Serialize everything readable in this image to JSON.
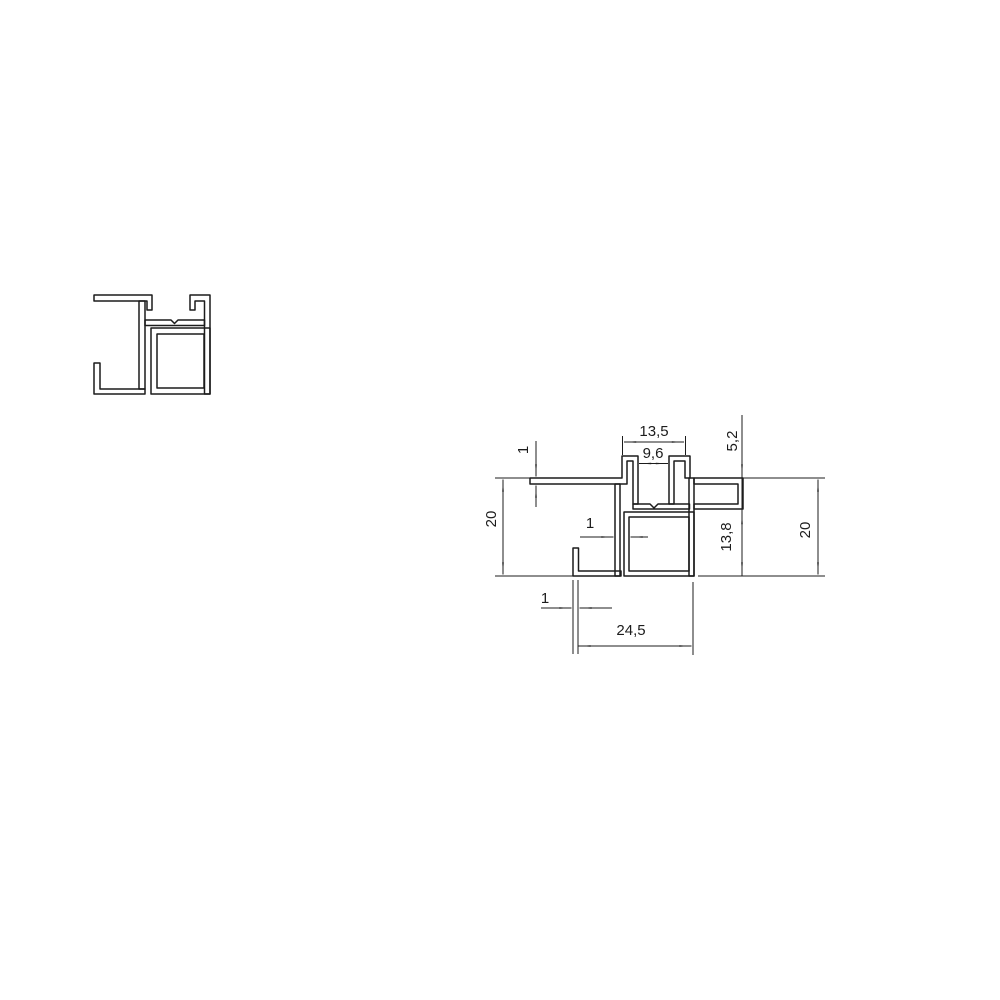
{
  "colors": {
    "background": "#ffffff",
    "line": "#1c1c1c"
  },
  "dimensions": {
    "slot_outer_width": "13,5",
    "slot_inner_width": "9,6",
    "slot_depth": "5,2",
    "flange_wall_thickness": "1",
    "overall_height_left": "20",
    "stem_wall_thickness": "1",
    "cavity_height": "13,8",
    "overall_height_right": "20",
    "hook_wall_thickness": "1",
    "overall_width": "24,5"
  }
}
